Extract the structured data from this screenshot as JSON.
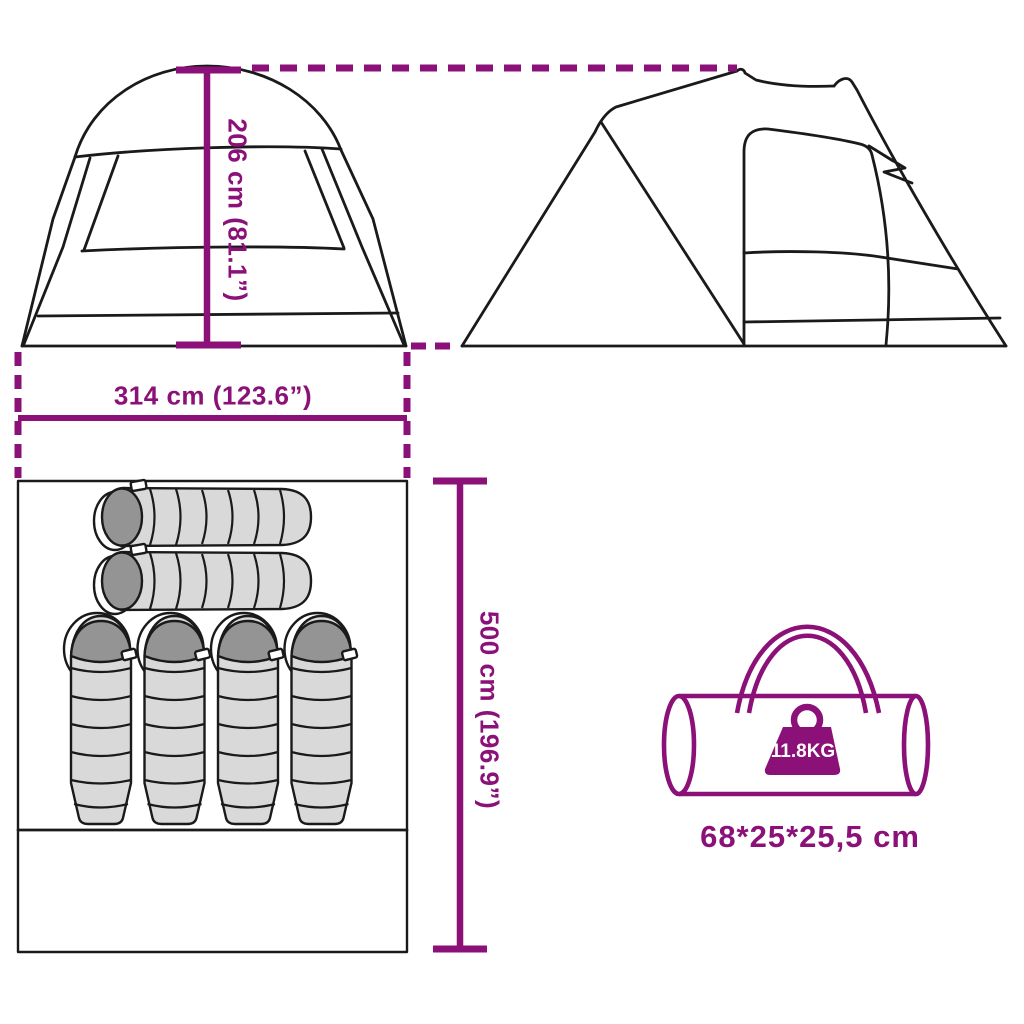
{
  "diagram_title": "tent-dimension-diagram",
  "accent_color": "#8B1178",
  "line_color": "#1a1a1a",
  "sleeping_bag_light": "#d9d9d9",
  "sleeping_bag_dark": "#949494",
  "dimensions": {
    "height": "206 cm (81.1”)",
    "width": "314 cm (123.6”)",
    "length": "500 cm (196.9”)"
  },
  "carry_bag": {
    "weight_label": "11.8KG",
    "size_label": "68*25*25,5 cm"
  },
  "contents": {
    "horizontal_sleeping_bags": 2,
    "vertical_sleeping_bags": 4
  }
}
